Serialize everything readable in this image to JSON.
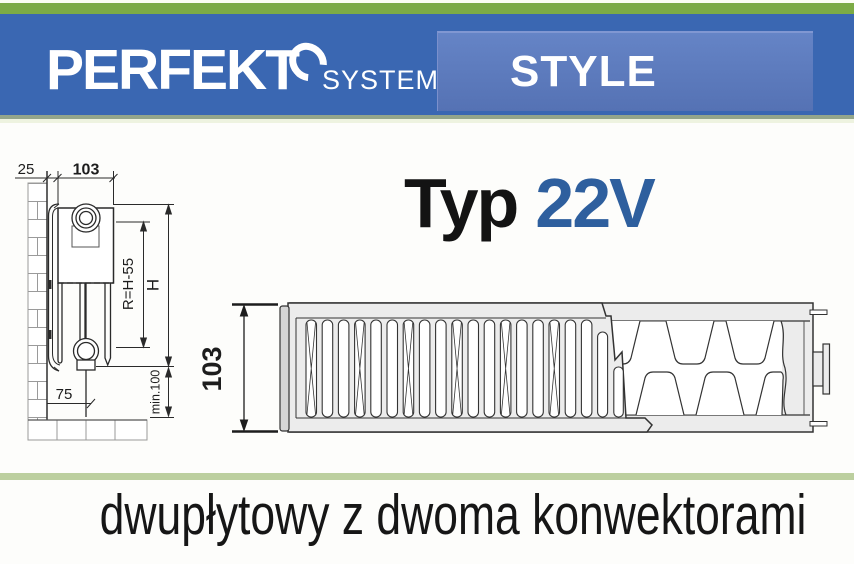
{
  "header": {
    "brand": "PERFEKT",
    "brand_sub": "SYSTEM",
    "series_label": "STYLE",
    "colors": {
      "green_bar": "#7cab45",
      "blue_bar": "#3a67b2",
      "style_panel": "#5b7abf"
    }
  },
  "type_label": {
    "prefix": "Typ",
    "value": "22V",
    "value_color": "#2e5f9e"
  },
  "side_view": {
    "dim_wall_gap": "25",
    "dim_depth": "103",
    "dim_connection": "R=H-55",
    "dim_height": "H",
    "dim_floor_offset": "75",
    "dim_min_clearance": "min.100"
  },
  "top_view": {
    "dim_depth": "103"
  },
  "caption": "dwupłytowy z dwoma konwektorami"
}
